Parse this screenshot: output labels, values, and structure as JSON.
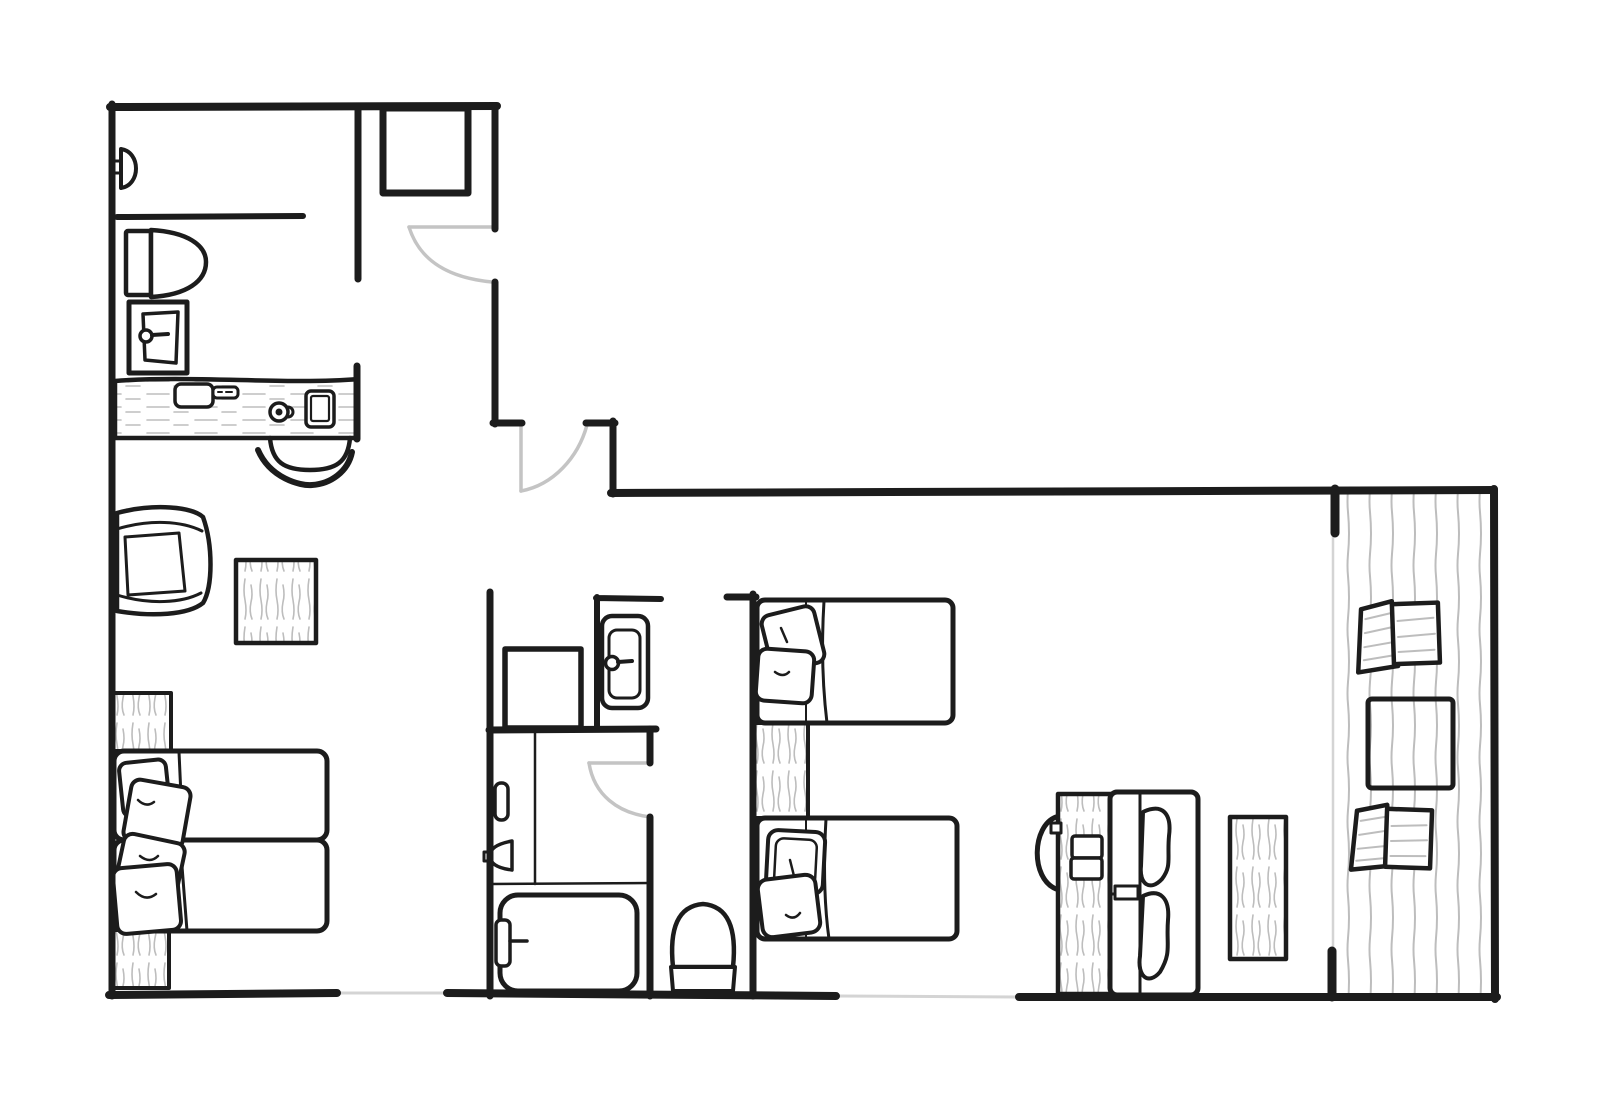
{
  "colors": {
    "background": "#ffffff",
    "ink": "#1c1c1c",
    "door": "#c4c4c4",
    "texture": "#bdbdbd",
    "glazing": "#d4d4d4"
  },
  "plan": {
    "type": "hand-drawn apartment floor plan, top view, no text labels",
    "areas": [
      {
        "name": "bathroom-top-left",
        "items": [
          "shower-head",
          "half-wall",
          "toilet",
          "vanity-sink",
          "storage-nook-shelf"
        ]
      },
      {
        "name": "study-bedroom-left",
        "items": [
          "wood-desk",
          "desk-pad",
          "remote",
          "coffee-cup",
          "tablet",
          "desk-chair",
          "armchair",
          "square-rug",
          "twin-bed",
          "twin-bed",
          "pillows",
          "bedside-runner-top",
          "bedside-runner-bottom"
        ]
      },
      {
        "name": "hallway",
        "items": [
          "entry-door-swing",
          "step-wall"
        ]
      },
      {
        "name": "bathroom-center",
        "items": [
          "storage-cube",
          "wash-basin",
          "toiletry-bottle",
          "wall-tap",
          "bathtub",
          "tub-faucet"
        ]
      },
      {
        "name": "wc-corridor",
        "items": [
          "toilet"
        ]
      },
      {
        "name": "bedroom-center",
        "items": [
          "twin-bed",
          "twin-bed",
          "pillows",
          "runner-rug-between-beds"
        ]
      },
      {
        "name": "bedroom-right",
        "items": [
          "reading-lamp-arc",
          "bedside-wood-mat",
          "slippers",
          "double-bed",
          "organic-pillows",
          "side-rug"
        ]
      },
      {
        "name": "balcony",
        "items": [
          "plank-deck-floor",
          "lounge-chair",
          "square-table",
          "lounge-chair"
        ]
      }
    ],
    "doors": [
      {
        "name": "door-top-left-bathroom",
        "swing": "opens-left-into-bathroom"
      },
      {
        "name": "door-hallway",
        "swing": "opens-down-into-hall"
      },
      {
        "name": "door-center-bathroom",
        "swing": "opens-left-into-bathroom"
      }
    ],
    "windows": [
      "bottom-wall-gray-gap-left",
      "bottom-wall-gray-gap-center",
      "balcony-glazing-line"
    ]
  }
}
